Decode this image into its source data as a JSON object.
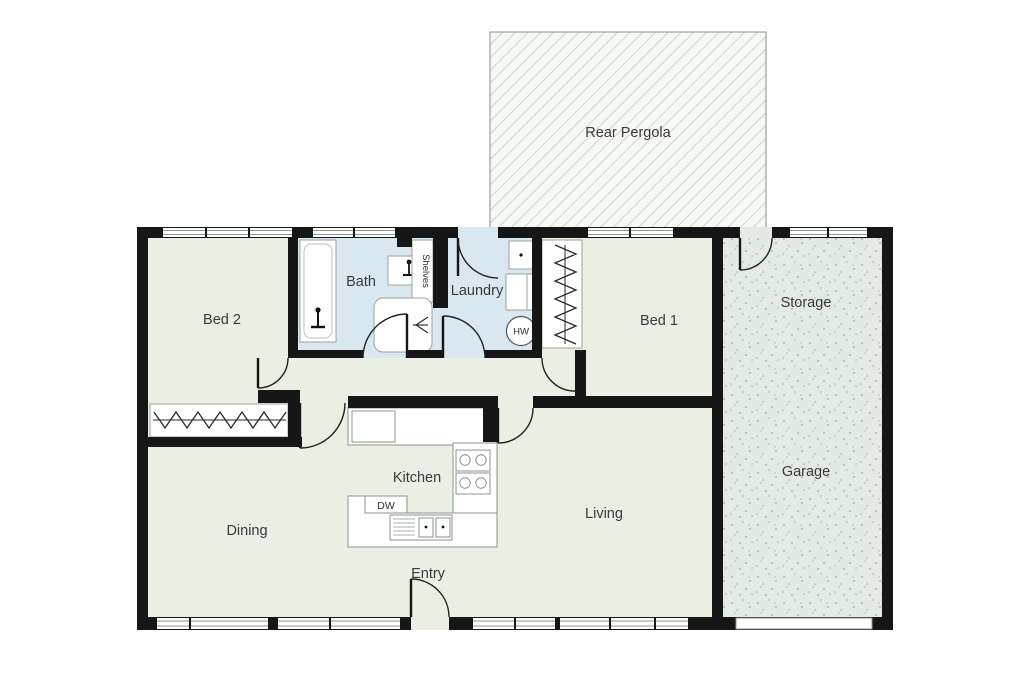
{
  "title": "Residential floor plan",
  "colors": {
    "wall": "#161616",
    "floor_green": "#e9efe2",
    "wet_floor_blue": "#d9e7f1",
    "garage_floor": "#e3eae4",
    "pergola_bg": "#f6f8f4",
    "hatch_line": "#b5bdb5",
    "speckle": "#9fab9f",
    "fixture_line": "#9aa39d",
    "text": "#3a3a3a"
  },
  "rooms": {
    "rear_pergola": {
      "label": "Rear Pergola"
    },
    "bed2": {
      "label": "Bed 2"
    },
    "bath": {
      "label": "Bath"
    },
    "laundry": {
      "label": "Laundry"
    },
    "bed1": {
      "label": "Bed 1"
    },
    "storage": {
      "label": "Storage"
    },
    "garage": {
      "label": "Garage"
    },
    "kitchen": {
      "label": "Kitchen"
    },
    "dining": {
      "label": "Dining"
    },
    "living": {
      "label": "Living"
    },
    "entry": {
      "label": "Entry"
    }
  },
  "fixtures": {
    "shelves": {
      "label": "Shelves"
    },
    "hot_water": {
      "label": "HW"
    },
    "dishwasher": {
      "label": "DW"
    }
  }
}
